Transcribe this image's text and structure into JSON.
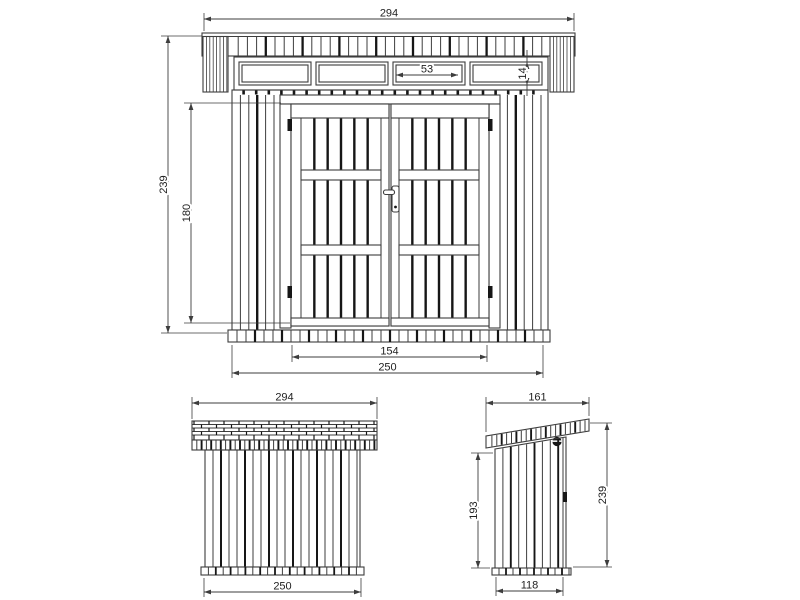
{
  "views": {
    "front": {
      "dims": {
        "roof_width": "294",
        "total_height": "239",
        "door_height": "180",
        "window_width": "53",
        "window_height": "14",
        "door_opening_width": "154",
        "wall_width": "250"
      }
    },
    "rear": {
      "dims": {
        "roof_width": "294",
        "wall_width": "250"
      }
    },
    "side": {
      "dims": {
        "roof_depth": "161",
        "overall_height": "239",
        "rear_wall_height": "193",
        "wall_depth": "118"
      }
    }
  },
  "colors": {
    "line": "#3d3d3d",
    "dark_line": "#161616",
    "text": "#222222",
    "background": "#ffffff"
  }
}
